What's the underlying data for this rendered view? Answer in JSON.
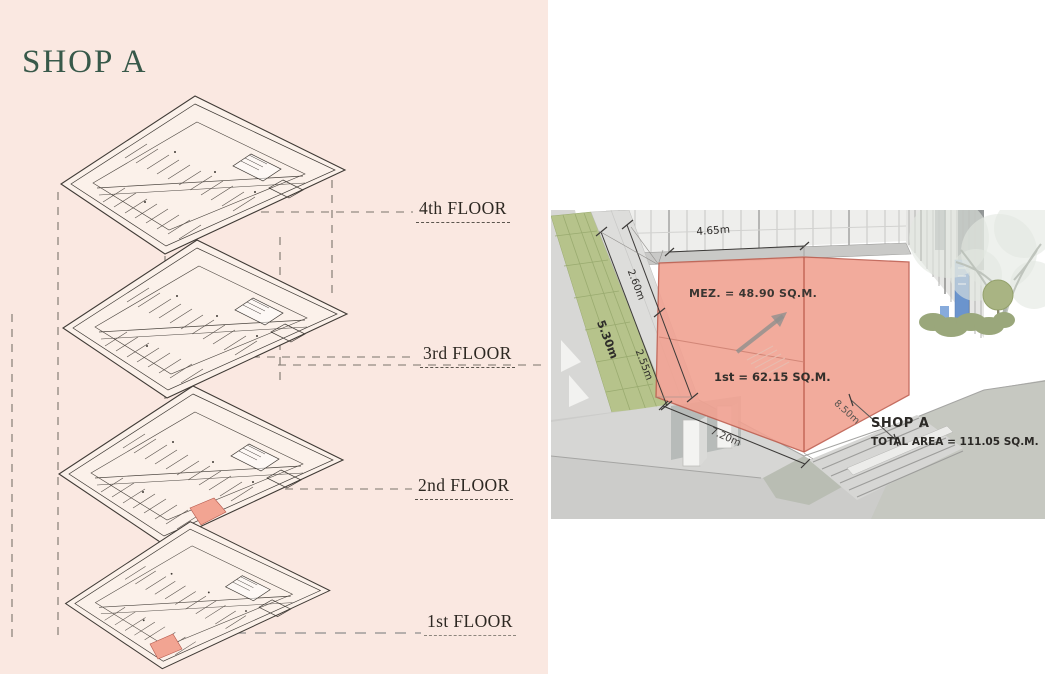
{
  "slide": {
    "title": "SHOP A"
  },
  "floor_stack": {
    "floors": [
      {
        "label": "4th FLOOR",
        "highlighted": false
      },
      {
        "label": "3rd FLOOR",
        "highlighted": false
      },
      {
        "label": "2nd FLOOR",
        "highlighted": true
      },
      {
        "label": "1st FLOOR",
        "highlighted": true
      }
    ]
  },
  "render": {
    "annotations": {
      "mezzanine_area": "MEZ. = 48.90 SQ.M.",
      "first_floor_area": "1st = 62.15 SQ.M.",
      "shop_name": "SHOP A",
      "total_area": "TOTAL AREA = 111.05 SQ.M."
    },
    "dimensions": {
      "top_width": "4.65m",
      "left_upper": "2.60m",
      "left_total": "5.30m",
      "left_lower": "2.55m",
      "front_left": "7.20m",
      "front_right": "8.50m"
    }
  },
  "colors": {
    "panel_pink": "#fae8e1",
    "title_green": "#38594a",
    "highlight_red": "#f1a292",
    "green_wall": "#b6c38b",
    "banner_blue": "#6b94cd"
  }
}
